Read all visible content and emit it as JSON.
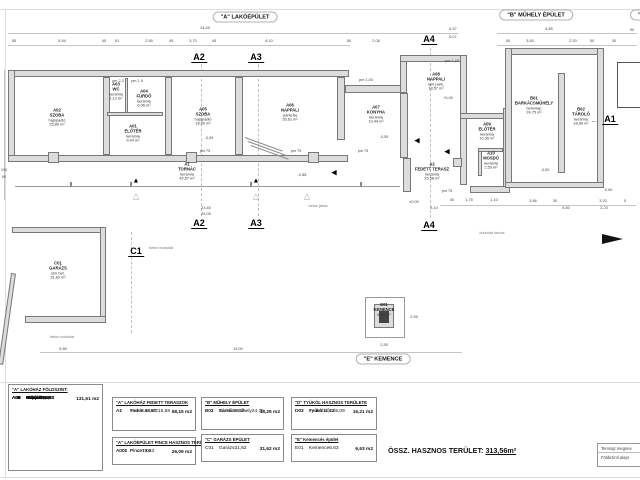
{
  "sheet": {
    "building_titles": [
      {
        "label": "\"A\" LAKÓÉPÜLET",
        "x": 245,
        "y": 17
      },
      {
        "label": "\"B\" MŰHELY ÉPÜLET",
        "x": 536,
        "y": 15
      },
      {
        "label": "\"D\" TYÚKÓL",
        "x": 655,
        "y": 15
      },
      {
        "label": "\"E\" KEMENCE",
        "x": 383,
        "y": 359
      }
    ],
    "section_markers": [
      {
        "label": "A2",
        "x": 199,
        "y": 52
      },
      {
        "label": "A3",
        "x": 256,
        "y": 52
      },
      {
        "label": "A4",
        "x": 429,
        "y": 34
      },
      {
        "label": "A2",
        "x": 199,
        "y": 218
      },
      {
        "label": "A3",
        "x": 256,
        "y": 218
      },
      {
        "label": "A4",
        "x": 429,
        "y": 220
      },
      {
        "label": "C1",
        "x": 136,
        "y": 246
      },
      {
        "label": "A1",
        "x": 610,
        "y": 114
      }
    ],
    "rooms": [
      {
        "code": "A02",
        "name": "SZOBA",
        "mat": "hajópadló",
        "area": "25,89 m²",
        "x": 57,
        "y": 118
      },
      {
        "code": "A03",
        "name": "WC",
        "mat": "kerámia",
        "area": "1,12 m²",
        "x": 116,
        "y": 92
      },
      {
        "code": "A04",
        "name": "FÜRDŐ",
        "mat": "kerámia",
        "area": "6,06 m²",
        "x": 144,
        "y": 99
      },
      {
        "code": "A01",
        "name": "ELŐTÉR",
        "mat": "kerámia",
        "area": "9,04 m²",
        "x": 133,
        "y": 134
      },
      {
        "code": "A05",
        "name": "SZOBA",
        "mat": "hajópadló",
        "area": "18,00 m²",
        "x": 203,
        "y": 117
      },
      {
        "code": "A06",
        "name": "NAPPALI",
        "mat": "parketta",
        "area": "26,61 m²",
        "x": 290,
        "y": 113
      },
      {
        "code": "A1",
        "name": "TORNÁC",
        "mat": "kerámia",
        "area": "42,57 m²",
        "x": 187,
        "y": 172
      },
      {
        "code": "A07",
        "name": "KONYHA",
        "mat": "kerámia",
        "area": "13,44 m²",
        "x": 376,
        "y": 115
      },
      {
        "code": "A08",
        "name": "NAPPALI",
        "mat": "lam.park.",
        "area": "18,57 m²",
        "x": 436,
        "y": 82
      },
      {
        "code": "A09",
        "name": "ELŐTÉR",
        "mat": "kerámia",
        "area": "10,35 m²",
        "x": 487,
        "y": 132
      },
      {
        "code": "A10",
        "name": "MOSDÓ",
        "mat": "kerámia",
        "area": "2,53 m²",
        "x": 491,
        "y": 161
      },
      {
        "code": "A2",
        "name": "FEDETT TERASZ",
        "mat": "kerámia",
        "area": "15,58 m²",
        "x": 432,
        "y": 172
      },
      {
        "code": "B01",
        "name": "BARKÁCSMŰHELY",
        "mat": "betonlap",
        "area": "24,75 m²",
        "x": 534,
        "y": 106
      },
      {
        "code": "B02",
        "name": "TÁROLÓ",
        "mat": "kerámia",
        "area": "18,50 m²",
        "x": 581,
        "y": 117
      },
      {
        "code": "C01",
        "name": "GARÁZS",
        "mat": "sim.bet.",
        "area": "31,62 m²",
        "x": 58,
        "y": 271
      },
      {
        "code": "E01",
        "name": "KEMENCE",
        "area": "6,63 m²",
        "x": 384,
        "y": 310
      }
    ],
    "dims": [
      {
        "t": "24,45",
        "x": 205,
        "y": 28
      },
      {
        "t": "55",
        "x": 14,
        "y": 41
      },
      {
        "t": "5,54",
        "x": 62,
        "y": 41
      },
      {
        "t": "45",
        "x": 104,
        "y": 41
      },
      {
        "t": "91",
        "x": 117,
        "y": 41
      },
      {
        "t": "2,55",
        "x": 149,
        "y": 41
      },
      {
        "t": "45",
        "x": 171,
        "y": 41
      },
      {
        "t": "3,70",
        "x": 193,
        "y": 41
      },
      {
        "t": "45",
        "x": 214,
        "y": 41
      },
      {
        "t": "6,10",
        "x": 269,
        "y": 41
      },
      {
        "t": "50",
        "x": 349,
        "y": 41
      },
      {
        "t": "2,08",
        "x": 376,
        "y": 41
      },
      {
        "t": "6,57",
        "x": 453,
        "y": 29
      },
      {
        "t": "6,07",
        "x": 453,
        "y": 37
      },
      {
        "t": "5,85",
        "x": 549,
        "y": 29
      },
      {
        "t": "90",
        "x": 632,
        "y": 30
      },
      {
        "t": "50",
        "x": 508,
        "y": 41
      },
      {
        "t": "3,50",
        "x": 530,
        "y": 41
      },
      {
        "t": "2,20",
        "x": 573,
        "y": 41
      },
      {
        "t": "50",
        "x": 592,
        "y": 41
      },
      {
        "t": "30",
        "x": 614,
        "y": 41
      },
      {
        "t": "pm 1,49",
        "x": 452,
        "y": 61
      },
      {
        "t": "pm 1,00",
        "x": 366,
        "y": 80
      },
      {
        "t": "pm 2,2",
        "x": 118,
        "y": 81
      },
      {
        "t": "pm 1,9",
        "x": 137,
        "y": 81
      },
      {
        "t": "pm 75",
        "x": 205,
        "y": 151
      },
      {
        "t": "pm 75",
        "x": 296,
        "y": 151
      },
      {
        "t": "pm 75",
        "x": 363,
        "y": 151
      },
      {
        "t": "pm 75",
        "x": 447,
        "y": 191
      },
      {
        "t": "100",
        "x": 4,
        "y": 170
      },
      {
        "t": "90",
        "x": 4,
        "y": 177
      },
      {
        "t": "-0,55",
        "x": 384,
        "y": 137
      },
      {
        "t": "-0,59",
        "x": 209,
        "y": 138
      },
      {
        "t": "-0,88",
        "x": 302,
        "y": 175
      },
      {
        "t": "+0,00",
        "x": 448,
        "y": 98
      },
      {
        "t": "-0,50",
        "x": 545,
        "y": 170
      },
      {
        "t": "-0,50",
        "x": 608,
        "y": 190
      },
      {
        "t": "±0,00",
        "x": 414,
        "y": 202
      },
      {
        "t": "3,10",
        "x": 434,
        "y": 208
      },
      {
        "t": "30",
        "x": 452,
        "y": 200
      },
      {
        "t": "1,75",
        "x": 469,
        "y": 200
      },
      {
        "t": "1,10",
        "x": 494,
        "y": 200
      },
      {
        "t": "3,86",
        "x": 533,
        "y": 201
      },
      {
        "t": "30",
        "x": 555,
        "y": 201
      },
      {
        "t": "3,20",
        "x": 603,
        "y": 201
      },
      {
        "t": "5",
        "x": 625,
        "y": 201
      },
      {
        "t": "6,60",
        "x": 566,
        "y": 208
      },
      {
        "t": "2,23",
        "x": 604,
        "y": 208
      },
      {
        "t": "23,45",
        "x": 206,
        "y": 208
      },
      {
        "t": "24,05",
        "x": 206,
        "y": 214
      },
      {
        "t": "5,85",
        "x": 63,
        "y": 349
      },
      {
        "t": "15,00",
        "x": 238,
        "y": 349
      },
      {
        "t": "2,55",
        "x": 384,
        "y": 345
      },
      {
        "t": "2,55",
        "x": 414,
        "y": 317
      }
    ],
    "notes": [
      {
        "t": "beton járda",
        "x": 318,
        "y": 206
      },
      {
        "t": "beton burkolat",
        "x": 161,
        "y": 248
      },
      {
        "t": "beton burkolat",
        "x": 62,
        "y": 337
      },
      {
        "t": "burkolat kavics",
        "x": 492,
        "y": 233
      }
    ],
    "symbols": [
      {
        "g": "▲",
        "x": 136,
        "y": 181
      },
      {
        "g": "▲",
        "x": 256,
        "y": 181
      },
      {
        "g": "◀",
        "x": 334,
        "y": 173
      },
      {
        "g": "◀",
        "x": 417,
        "y": 141
      },
      {
        "g": "◀",
        "x": 447,
        "y": 152
      },
      {
        "g": "△",
        "x": 136,
        "y": 196,
        "cls": "hollow"
      },
      {
        "g": "△",
        "x": 256,
        "y": 196,
        "cls": "hollow"
      },
      {
        "g": "△",
        "x": 307,
        "y": 196,
        "cls": "hollow"
      }
    ],
    "tables": {
      "foldszint": {
        "header": "\"A\" LAKÓHÁZ FÖLDSZINT:",
        "rows": [
          {
            "c": "A01",
            "n": "Előtér",
            "v": "9,04"
          },
          {
            "c": "A02",
            "n": "Szoba",
            "v": "25,89"
          },
          {
            "c": "A03",
            "n": "WC",
            "v": "1,12"
          },
          {
            "c": "A04",
            "n": "Fürdő",
            "v": "6,06"
          },
          {
            "c": "A05",
            "n": "Szoba",
            "v": "18,00"
          },
          {
            "c": "A06",
            "n": "Nappali",
            "v": "26,61"
          },
          {
            "c": "A07",
            "n": "Konyha",
            "v": "13,44"
          },
          {
            "c": "A08",
            "n": "Nappali",
            "v": "18,57"
          },
          {
            "c": "A09",
            "n": "Előtér",
            "v": "10,35"
          },
          {
            "c": "A10",
            "n": "Mosdó",
            "v": "2,53"
          }
        ],
        "total": "131,61 m2"
      },
      "teraszok": {
        "header": "\"A\" LAKÓHÁZ FEDETT TERASZOK",
        "rows": [
          {
            "c": "A1",
            "n": "Tornác",
            "v": "42,57"
          },
          {
            "c": "A2",
            "n": "Fedett terasz",
            "v": "15,58"
          }
        ],
        "total": "58,15 m2"
      },
      "pince": {
        "header": "\"A\" LAKÓÉPÜLET PINCE HASZNOS TERÜLETE:",
        "rows": [
          {
            "c": "A001",
            "n": "Pince",
            "v": "19,03"
          },
          {
            "c": "A002",
            "n": "Pince",
            "v": "7,06"
          }
        ],
        "total": "26,09 m2"
      },
      "muhely": {
        "header": "\"B\" MŰHELY ÉPÜLET",
        "rows": [
          {
            "c": "B01",
            "n": "Barkácsműhely",
            "v": "24,75"
          },
          {
            "c": "B02",
            "n": "Tároló",
            "v": "18,50"
          }
        ],
        "total": "43,25 m2"
      },
      "garazs": {
        "header": "\"C\" GARÁZS ÉPÜLET",
        "rows": [
          {
            "c": "C01",
            "n": "Garázs",
            "v": "31,62"
          }
        ],
        "total": "31,62 m2"
      },
      "tyukol": {
        "header": "\"D\" TYÚKÓL HASZNOS TERÜLETE",
        "rows": [
          {
            "c": "D01",
            "n": "Fedett kifutó",
            "v": "5,09"
          },
          {
            "c": "D02",
            "n": "Tyúkól",
            "v": "11,12"
          }
        ],
        "total": "16,21 m2"
      },
      "kemence": {
        "header": "\"E\" Kemencés épület",
        "rows": [
          {
            "c": "E01",
            "n": "Kemence",
            "v": "6,63"
          }
        ],
        "total": "6,63 m2"
      }
    },
    "grand_total": {
      "label": "ÖSSZ. HASZNOS TERÜLET:",
      "value": "313,56m²"
    },
    "titleblock": {
      "line1": "Tervrajz megnev",
      "line2": "Földszinti alapr"
    }
  }
}
